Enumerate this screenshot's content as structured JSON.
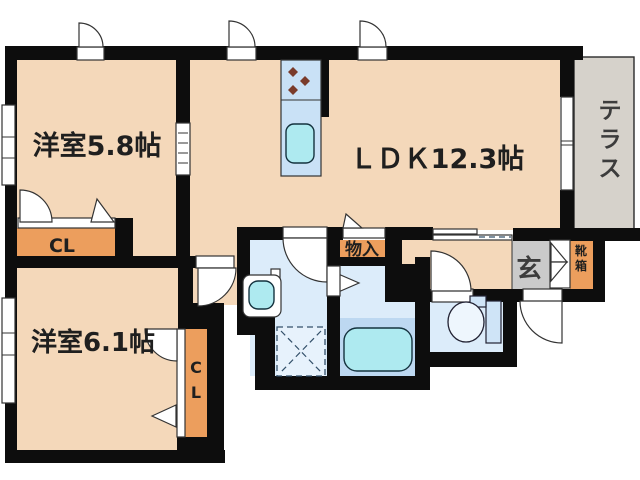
{
  "labels": {
    "room1": "洋室5.8帖",
    "ldk": "ＬＤＫ12.3帖",
    "room2": "洋室6.1帖",
    "terrace": "テラス",
    "closet1": "CL",
    "closet2": "CL",
    "storage": "物入",
    "entrance": "玄",
    "shoebox": "靴箱"
  },
  "colors": {
    "room": "#f4d8ba",
    "closet": "#ec9e5d",
    "water": "#dcecfa",
    "water_band": "#bdd8f1",
    "kitchen": "#c9e1f6",
    "fixture": "#aeeaf0",
    "tank": "#cfe4f7",
    "bowl": "#eef6fd",
    "genkan": "#cacaca",
    "terrace": "#d6d2cb",
    "wall": "#0d0d0d",
    "text": "#1f1f1f"
  }
}
